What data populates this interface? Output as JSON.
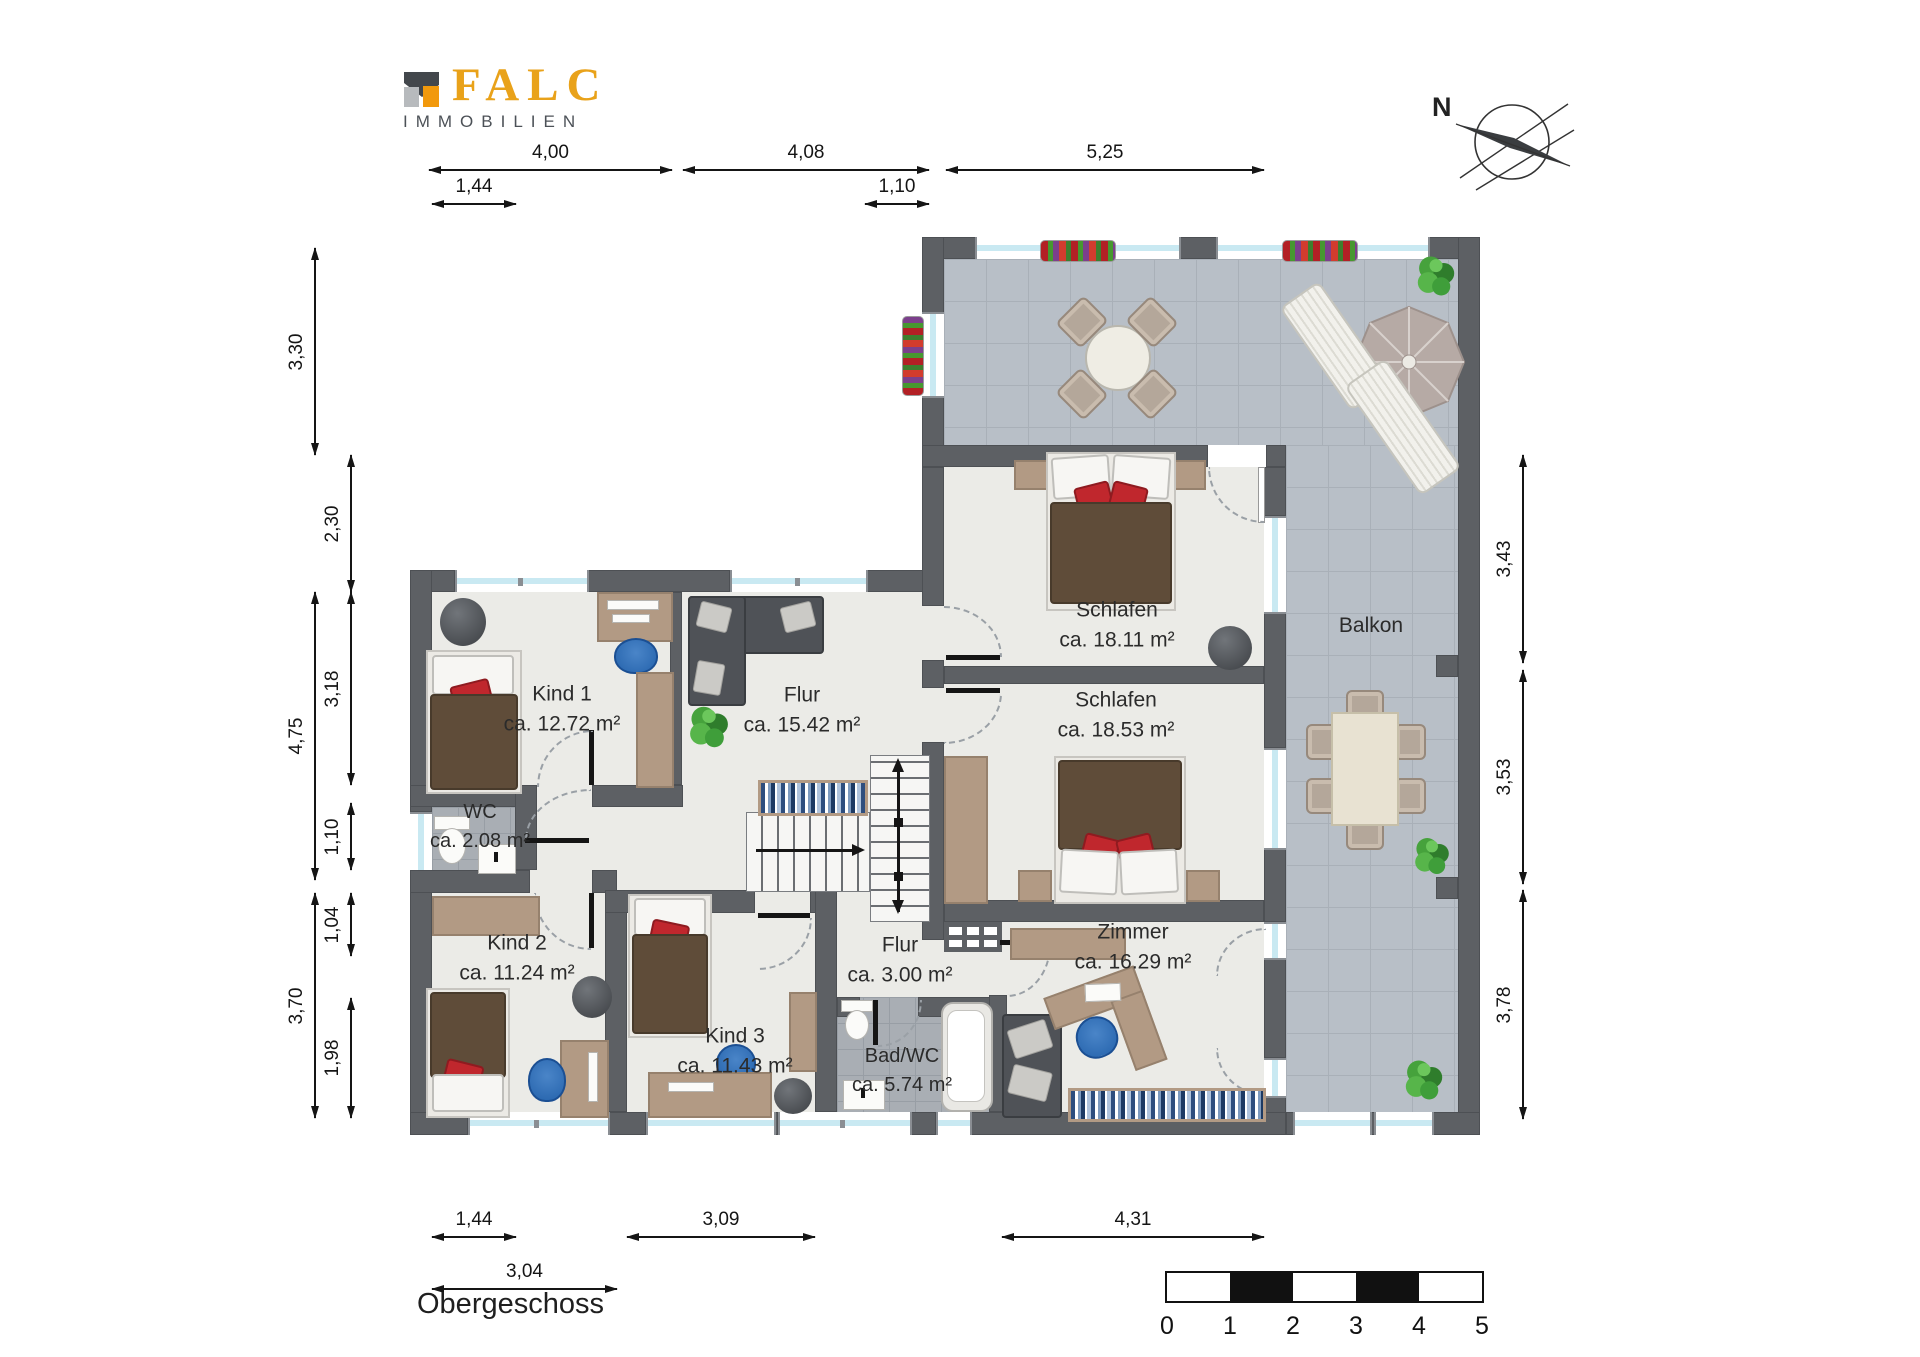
{
  "brand": {
    "name": "FALC",
    "subtitle": "IMMOBILIEN"
  },
  "compass": {
    "north_label": "N"
  },
  "floor": {
    "title": "Obergeschoss"
  },
  "rooms": {
    "schlafen1": {
      "name": "Schlafen",
      "area": "ca. 18.11 m²"
    },
    "schlafen2": {
      "name": "Schlafen",
      "area": "ca. 18.53 m²"
    },
    "balkon": {
      "name": "Balkon"
    },
    "kind1": {
      "name": "Kind 1",
      "area": "ca. 12.72 m²"
    },
    "flur": {
      "name": "Flur",
      "area": "ca. 15.42 m²"
    },
    "wc": {
      "name": "WC",
      "area": "ca. 2.08 m²"
    },
    "kind2": {
      "name": "Kind 2",
      "area": "ca. 11.24 m²"
    },
    "kind3": {
      "name": "Kind 3",
      "area": "ca. 11.43 m²"
    },
    "flur2": {
      "name": "Flur",
      "area": "ca. 3.00 m²"
    },
    "bad": {
      "name": "Bad/WC",
      "area": "ca. 5.74 m²"
    },
    "zimmer": {
      "name": "Zimmer",
      "area": "ca. 16.29 m²"
    }
  },
  "dims": {
    "top": [
      "4,00",
      "4,08",
      "5,25"
    ],
    "top_minor": [
      "1,44",
      "1,10"
    ],
    "left_outer": [
      "3,30",
      "4,75",
      "3,70"
    ],
    "left_inner": [
      "2,30",
      "3,18",
      "1,10",
      "1,04",
      "1,98"
    ],
    "right": [
      "3,43",
      "3,53",
      "3,78"
    ],
    "bottom": [
      "1,44",
      "3,09",
      "4,31"
    ],
    "bottom_minor": [
      "3,04"
    ]
  },
  "scalebar": {
    "ticks": [
      "0",
      "1",
      "2",
      "3",
      "4",
      "5"
    ]
  },
  "colors": {
    "brand_gold": "#e9a21a",
    "wall": "#5d6064",
    "room_floor": "#ebebe7",
    "terrace_tile": "#b8bfc7",
    "bath_tile": "#a9aeb4",
    "accent_red": "#c0272d",
    "wood": "#b29a84",
    "chair_blue": "#2563ac"
  }
}
